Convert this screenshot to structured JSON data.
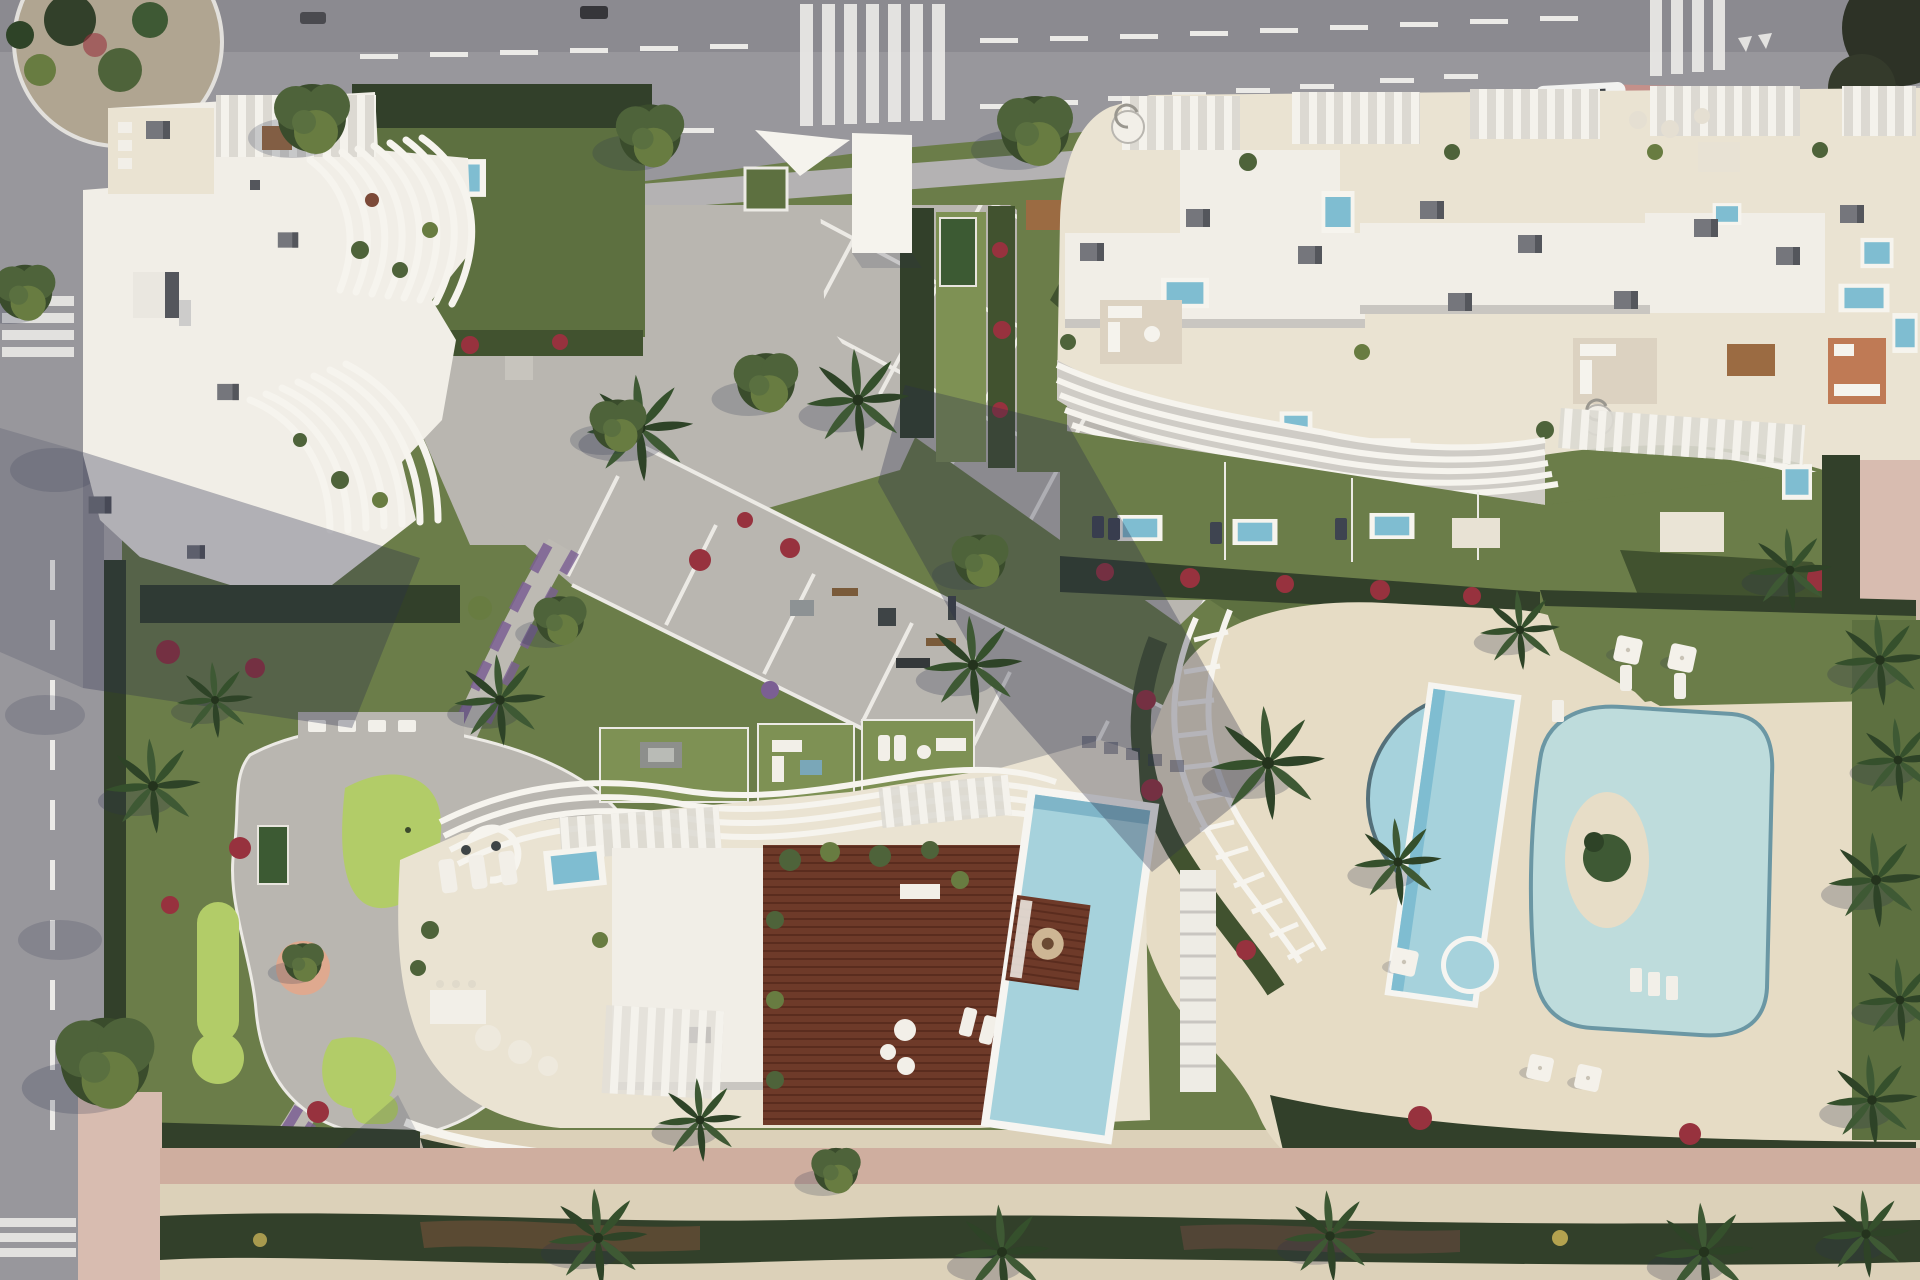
{
  "title": "Aerial render of a seaside residential development",
  "scene": {
    "type": "aerial-architectural-render",
    "no_visible_text": true,
    "regions": {
      "top_road": "avenue with lane dashes, arrow, zebra crossings, white van and roundabout with cactus island",
      "left_road": "side road with dashed centre line, two zebra crossings and street trees",
      "building_nw": "apartment block with curved white louver fins and rooftop terraces",
      "building_ne": "long terraced block with rooftop plunge pools, pergolas and wavy balconies",
      "building_s": "south block with timber deck, fire-pit island and private lap pool",
      "plaza": "central paved plaza with white diagonal grid and shaded walkway",
      "gardens": "lawns with outdoor gym, lounge lawns, bougainvillea and palm trees",
      "minigolf": "putting greens and peach-coloured sand circle",
      "pool_deck": "cream deck with crescent pool, lap pool, lagoon pool with island and round kids pool",
      "promenade": "pink footpath, sand strip, dark dune hedge and beach palms"
    }
  },
  "colors": {
    "road": "#98979c",
    "roadDark": "#8b8a90",
    "sidewalk": "#b4b2b3",
    "mark": "#ebeae7",
    "curb": "#d2d0cc",
    "paving": "#b9b6b0",
    "pavingLight": "#c7c4bd",
    "gridline": "#eceae5",
    "white": "#f5f3ed",
    "roofWhite": "#f1eee7",
    "slabShade": "#c9c6c1",
    "terrace": "#eae3d2",
    "deckCream": "#e6dcc5",
    "lawn": "#6b7d49",
    "lawnLight": "#7e9154",
    "lawnDark": "#5d7040",
    "golf": "#b2cc68",
    "hedge": "#41522f",
    "hedgeDark": "#32402a",
    "red": "#97323e",
    "purple": "#7b5f93",
    "poolBlue": "#7fbdd1",
    "poolLight": "#a6d2dc",
    "poolPale": "#bedcdc",
    "poolDeep": "#4f8fab",
    "poolRim": "#f6f5f1",
    "wood": "#6e3a29",
    "woodDark": "#57291c",
    "sand": "#dcd1b9",
    "sandLight": "#e7ddc7",
    "pinkPath": "#cfae9f",
    "pinkSide": "#d8bcb0",
    "shadow": "rgba(43,48,76,.32)",
    "shadowSoft": "rgba(43,48,76,.18)",
    "ac": "#75767c",
    "acDark": "#54565c",
    "tree": "#4e633a",
    "treeDark": "#3a4c2c",
    "treeLight": "#687c41",
    "palm": "#3e5934",
    "palmDark": "#2e4327",
    "rug": "#dcd2c1",
    "rugOrange": "#bf7a55",
    "tableWood": "#9b6b42"
  }
}
